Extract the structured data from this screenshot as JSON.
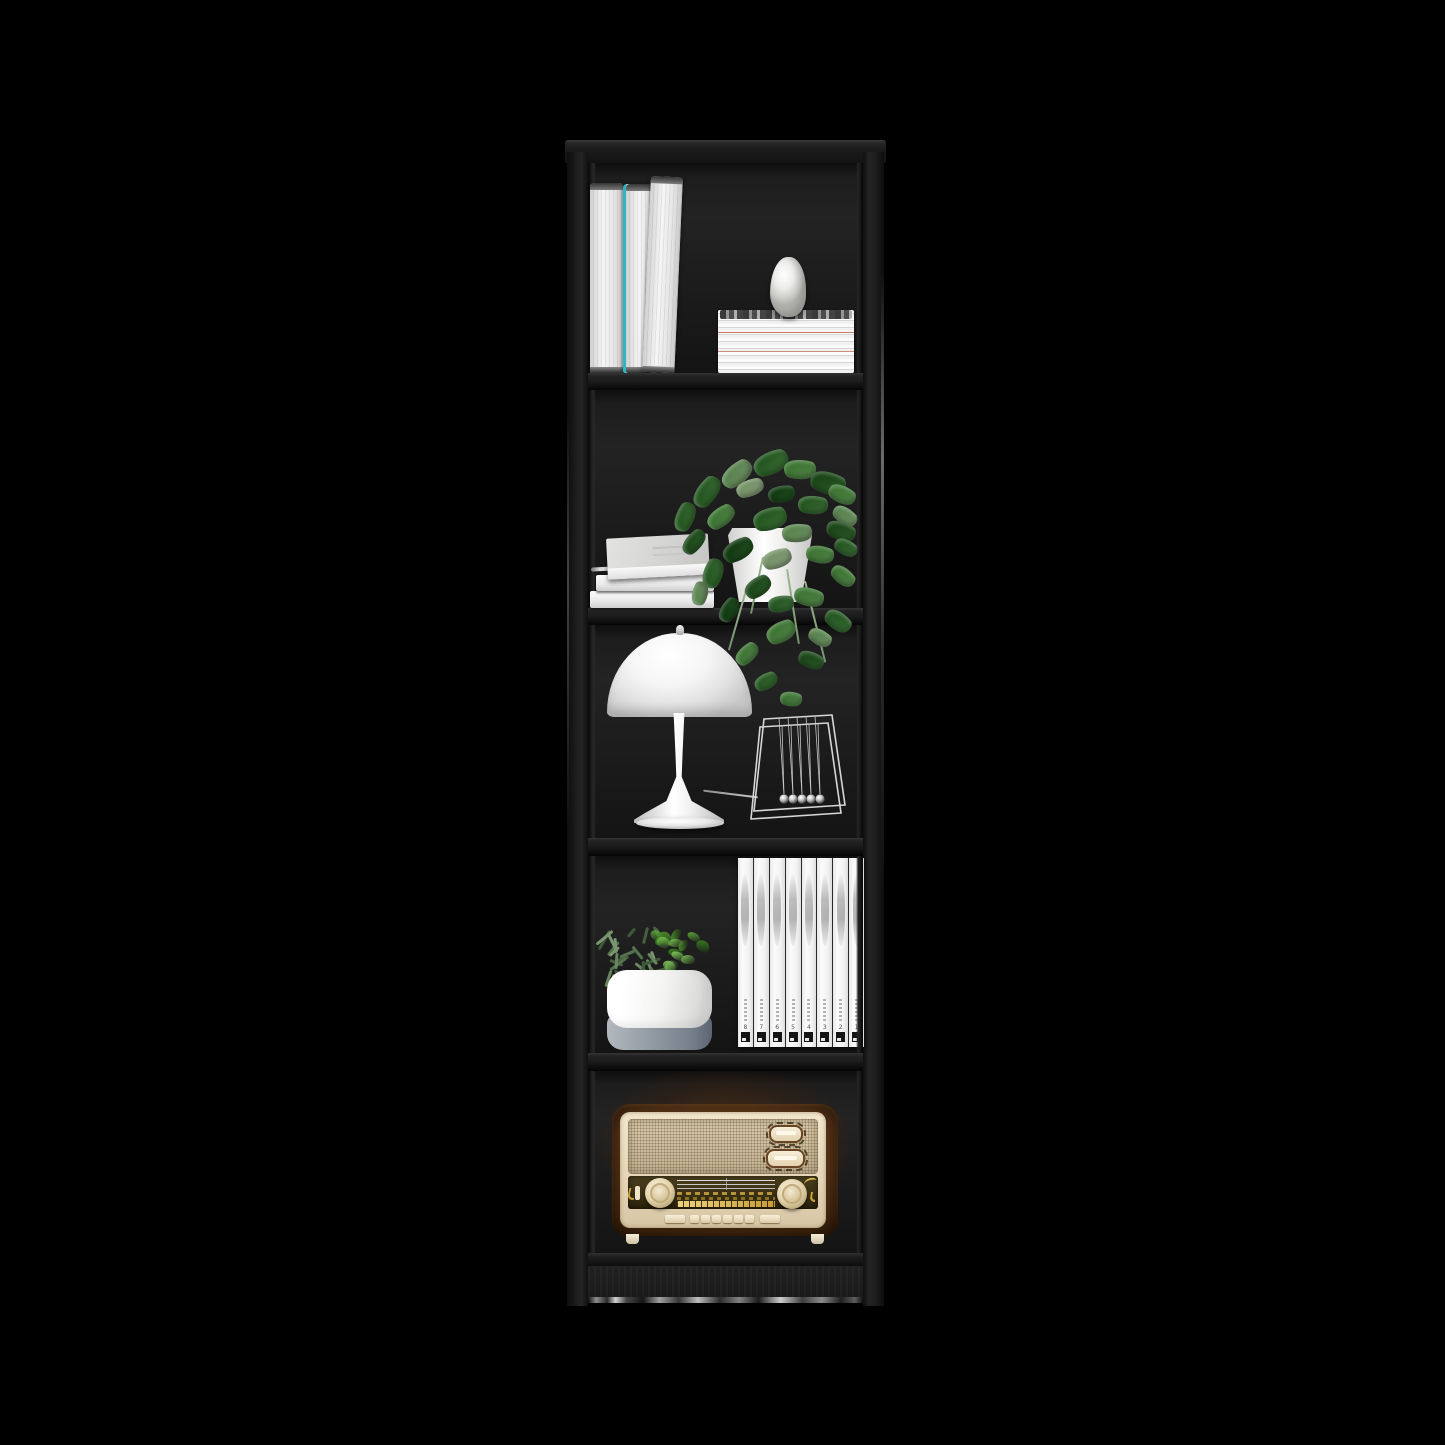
{
  "image": {
    "type": "product-photo",
    "subject": "Tall narrow 5-shelf bookcase in black finish, styled with decor",
    "background_hex": "#000000"
  },
  "bookcase": {
    "label": "5-shelf bookcase",
    "finish": "black",
    "frame_hex": "#1b1b1b",
    "shelf_count": 5
  },
  "shelves": [
    {
      "name": "shelf-1",
      "items": [
        "two standing white books",
        "leaning white book",
        "stack of white magazines",
        "white stone figurine"
      ]
    },
    {
      "name": "shelf-2",
      "items": [
        "stack of flat white books with pencil",
        "pothos plant in white pot with trailing vines"
      ]
    },
    {
      "name": "shelf-3",
      "items": [
        "white mushroom table lamp",
        "newtons cradle"
      ]
    },
    {
      "name": "shelf-4",
      "items": [
        "white herb planter with rosemary and basil",
        "row of 8 white dvd cases"
      ]
    },
    {
      "name": "shelf-5",
      "items": [
        "vintage radio in wood and cream"
      ]
    }
  ],
  "dvd_spines": {
    "numbers": [
      "8",
      "7",
      "6",
      "5",
      "4",
      "3",
      "2",
      "1"
    ]
  },
  "palette": {
    "accent_teal": "#2ab7c9",
    "plant_green_dark": "#2f6b2e",
    "plant_green_mid": "#4f8c49",
    "plant_green_pale": "#a9c19c",
    "radio_wood": "#5a3517",
    "radio_cream": "#ead9bd",
    "radio_gold": "#c9a23f",
    "magazine_red_line": "#c9746a"
  }
}
